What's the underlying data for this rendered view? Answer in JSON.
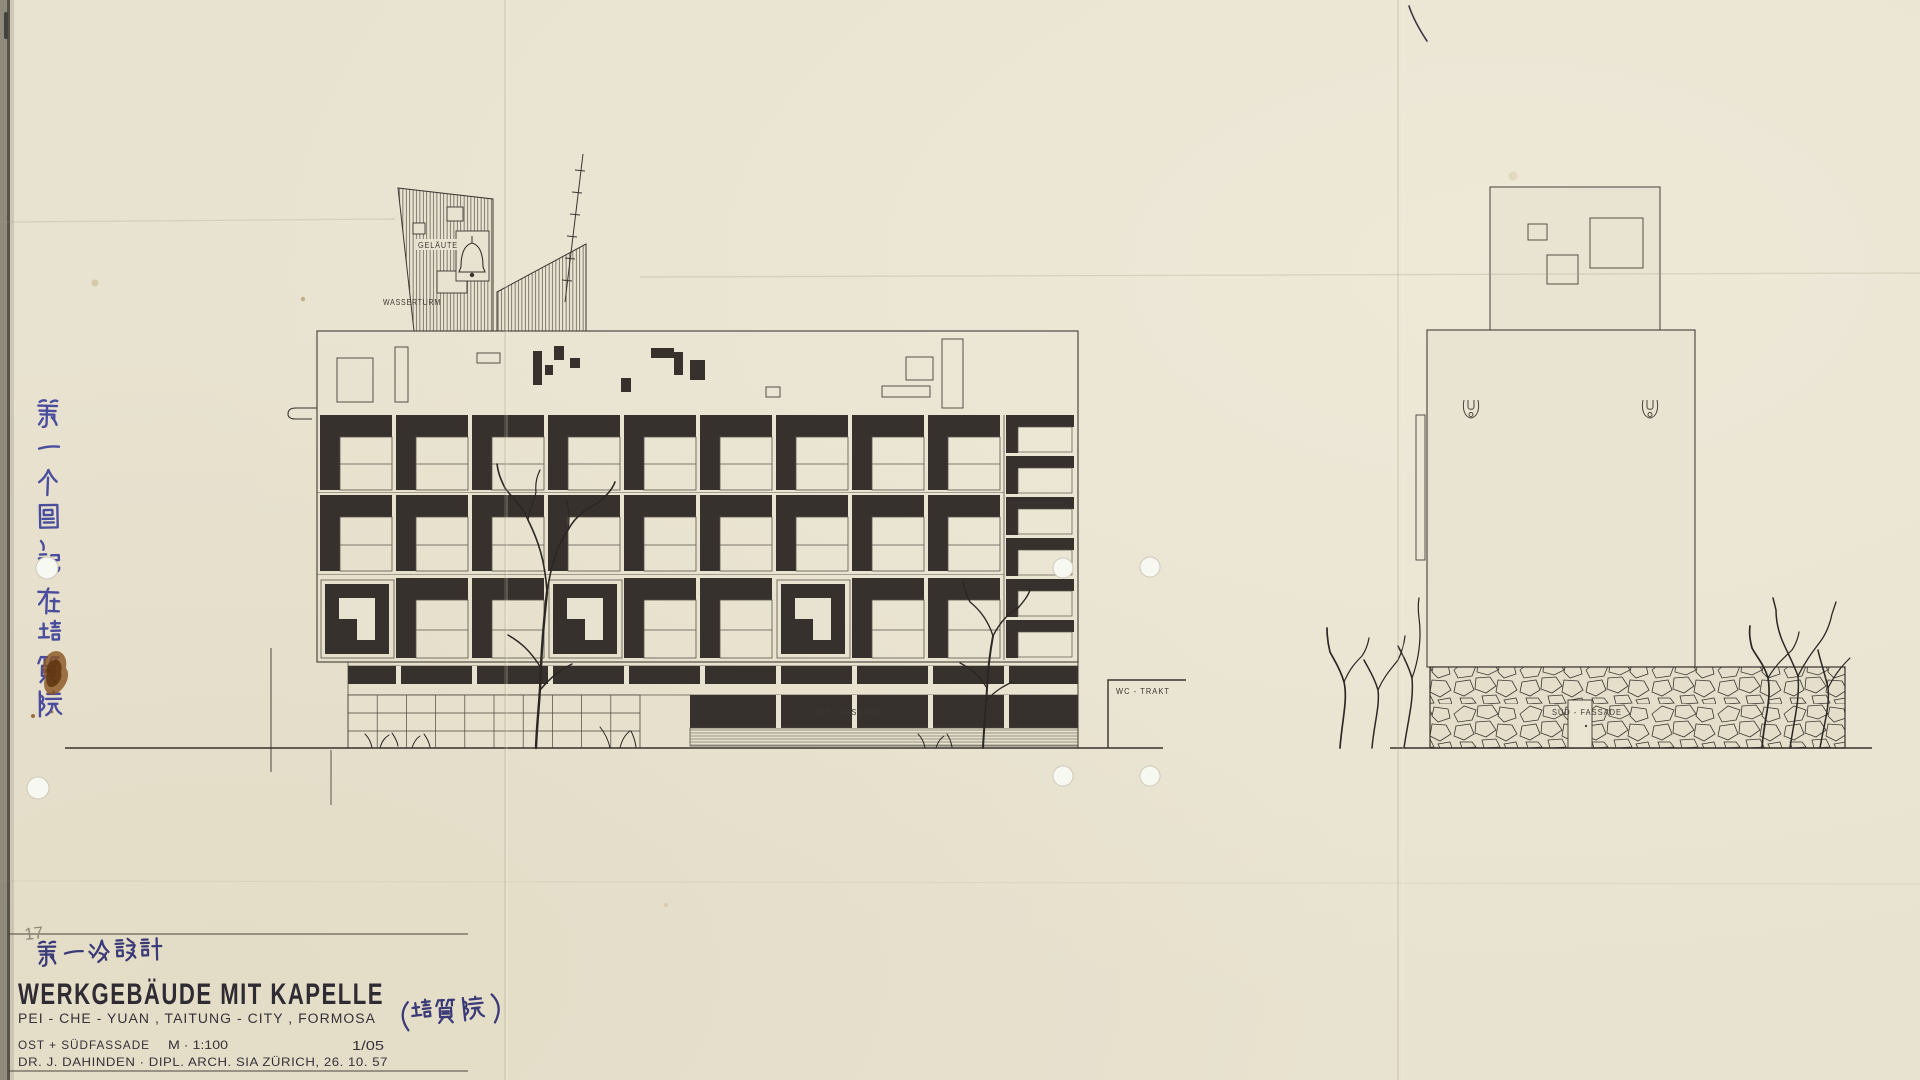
{
  "sheet": {
    "pencil_number": "17",
    "title": "WERKGEBÄUDE MIT KAPELLE",
    "location_line": "PEI - CHE - YUAN , TAITUNG - CITY , FORMOSA",
    "location_annotation_cjk": "(培質院)",
    "design_note_cjk": "第一次設計",
    "margin_note_cjk": "第一个圖，記在培質院",
    "facade_line": "OST + SÜDFASSADE",
    "scale": "M · 1:100",
    "sheet_number": "1/05",
    "author_line": "DR. J. DAHINDEN  ·  DIPL. ARCH. SIA  ZÜRICH, 26. 10. 57"
  },
  "labels": {
    "bell": "GELÄUTE",
    "water_tower": "WASSERTURM",
    "wc_wing": "WC - TRAKT",
    "east_facade": "OST - FASSADE",
    "south_facade": "SÜD - FASSADE"
  },
  "colors": {
    "paper": "#e8e2d0",
    "paper_dark": "#e2dbc6",
    "ink": "#37312d",
    "line": "#44403a",
    "hairline": "#5a544c",
    "blue_ink": "#4a4d9e",
    "blue_ink_dark": "#3b3a78",
    "title_ink": "#332f38",
    "stain": "#7d4418",
    "pencil": "#8d8778"
  },
  "facade": {
    "rows": 3,
    "bays": 9,
    "special_bays": [
      0,
      3,
      6
    ],
    "narrow_column_cells": 6
  }
}
